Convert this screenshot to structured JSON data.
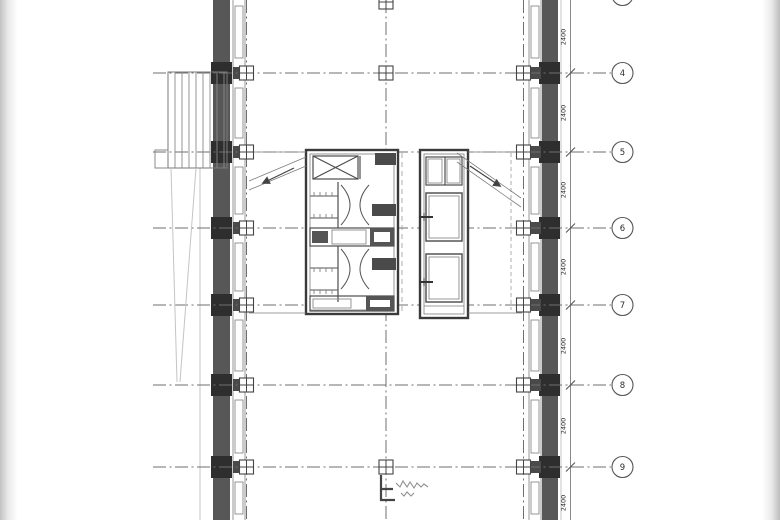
{
  "document": {
    "kind": "architectural-floor-plan",
    "sheet_background": "#ffffff"
  },
  "grid": {
    "bubble_labels": [
      "4",
      "5",
      "6",
      "7",
      "8",
      "9"
    ]
  },
  "dimensions": {
    "values": [
      "2400",
      "2400",
      "2400",
      "2400",
      "2400",
      "2400",
      "2400"
    ]
  },
  "colors": {
    "line": "#4c4c4c",
    "wall_fill": "#575757",
    "column_fill": "#2e2e2e",
    "window_block": "#4a4a4a",
    "faint": "#c4c4c4",
    "page_shadow": "#c2c2c2"
  }
}
